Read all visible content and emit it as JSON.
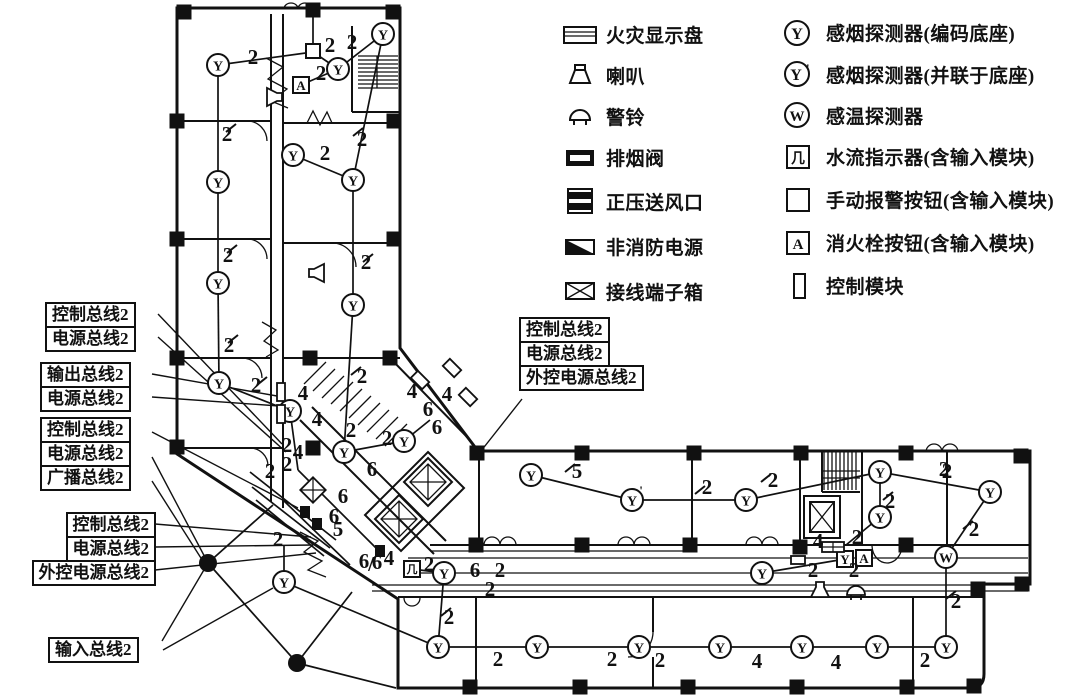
{
  "legend": {
    "left": [
      {
        "icon": "fire-display-panel",
        "label": "火灾显示盘"
      },
      {
        "icon": "speaker",
        "label": "喇叭"
      },
      {
        "icon": "alarm-bell",
        "label": "警铃"
      },
      {
        "icon": "smoke-exhaust-valve",
        "label": "排烟阀"
      },
      {
        "icon": "pressurized-air-outlet",
        "label": "正压送风口"
      },
      {
        "icon": "non-fire-power",
        "label": "非消防电源"
      },
      {
        "icon": "terminal-box",
        "label": "接线端子箱"
      }
    ],
    "right": [
      {
        "icon": "smoke-detector-coded-base",
        "label": "感烟探测器(编码底座)"
      },
      {
        "icon": "smoke-detector-parallel-base",
        "label": "感烟探测器(并联于底座)"
      },
      {
        "icon": "heat-detector",
        "label": "感温探测器"
      },
      {
        "icon": "water-flow-indicator",
        "label": "水流指示器(含输入模块)"
      },
      {
        "icon": "manual-alarm-button",
        "label": "手动报警按钮(含输入模块)"
      },
      {
        "icon": "hydrant-button",
        "label": "消火栓按钮(含输入模块)"
      },
      {
        "icon": "control-module",
        "label": "控制模块"
      }
    ],
    "glyphs": {
      "smoke": "Y",
      "smoke_parallel": "Y'",
      "heat": "W",
      "flow": "几",
      "hydrant": "A"
    }
  },
  "bus_labels": {
    "group_a": [
      "控制总线2",
      "电源总线2"
    ],
    "group_b": [
      "输出总线2",
      "电源总线2"
    ],
    "group_c": [
      "控制总线2",
      "电源总线2",
      "广播总线2"
    ],
    "group_d": [
      "控制总线2",
      "电源总线2",
      "外控电源总线2"
    ],
    "group_e": [
      "输入总线2"
    ],
    "group_mid": [
      "控制总线2",
      "电源总线2",
      "外控电源总线2"
    ]
  },
  "plan": {
    "colors": {
      "ink": "#111111",
      "paper": "#ffffff"
    },
    "wires": [
      [
        218,
        65,
        218,
        182
      ],
      [
        218,
        182,
        218,
        283
      ],
      [
        218,
        283,
        219,
        383
      ],
      [
        219,
        383,
        290,
        411
      ],
      [
        218,
        65,
        313,
        52
      ],
      [
        313,
        52,
        338,
        69
      ],
      [
        383,
        34,
        338,
        69
      ],
      [
        301,
        85,
        338,
        69
      ],
      [
        383,
        34,
        353,
        180
      ],
      [
        293,
        155,
        353,
        180
      ],
      [
        353,
        180,
        353,
        305
      ],
      [
        353,
        305,
        344,
        452
      ],
      [
        344,
        452,
        404,
        441
      ],
      [
        290,
        411,
        298,
        470
      ],
      [
        404,
        441,
        430,
        420
      ],
      [
        313,
        46,
        313,
        12
      ],
      [
        250,
        472,
        336,
        540
      ],
      [
        252,
        487,
        330,
        548
      ],
      [
        256,
        500,
        324,
        556
      ],
      [
        283,
        500,
        350,
        565
      ],
      [
        298,
        470,
        380,
        552
      ],
      [
        284,
        582,
        284,
        546
      ],
      [
        284,
        582,
        438,
        647
      ],
      [
        208,
        563,
        297,
        663
      ],
      [
        208,
        563,
        273,
        505
      ],
      [
        297,
        663,
        352,
        592
      ],
      [
        297,
        663,
        396,
        688
      ],
      [
        444,
        573,
        438,
        647
      ],
      [
        438,
        647,
        537,
        647
      ],
      [
        537,
        647,
        639,
        647
      ],
      [
        639,
        647,
        720,
        647
      ],
      [
        720,
        647,
        802,
        647
      ],
      [
        802,
        647,
        877,
        647
      ],
      [
        877,
        647,
        946,
        647
      ],
      [
        946,
        647,
        946,
        557
      ],
      [
        946,
        557,
        990,
        492
      ],
      [
        990,
        492,
        880,
        472
      ],
      [
        880,
        472,
        880,
        517
      ],
      [
        880,
        472,
        746,
        500
      ],
      [
        746,
        500,
        632,
        500
      ],
      [
        632,
        500,
        531,
        475
      ],
      [
        762,
        573,
        845,
        559
      ],
      [
        880,
        517,
        846,
        545
      ],
      [
        412,
        569,
        444,
        573
      ]
    ],
    "leaders": [
      [
        158,
        314,
        282,
        444
      ],
      [
        158,
        337,
        286,
        452
      ],
      [
        152,
        374,
        277,
        396
      ],
      [
        152,
        397,
        279,
        406
      ],
      [
        152,
        432,
        298,
        508
      ],
      [
        152,
        457,
        208,
        563
      ],
      [
        152,
        481,
        206,
        566
      ],
      [
        155,
        524,
        311,
        537
      ],
      [
        155,
        547,
        313,
        545
      ],
      [
        155,
        570,
        316,
        553
      ],
      [
        162,
        641,
        208,
        563
      ],
      [
        163,
        650,
        273,
        588
      ],
      [
        522,
        399,
        481,
        451
      ]
    ],
    "labels": [
      [
        253,
        57,
        "2"
      ],
      [
        330,
        45,
        "2"
      ],
      [
        352,
        42,
        "2"
      ],
      [
        321,
        73,
        "2"
      ],
      [
        362,
        139,
        "2"
      ],
      [
        325,
        153,
        "2"
      ],
      [
        227,
        134,
        "2"
      ],
      [
        228,
        255,
        "2"
      ],
      [
        366,
        262,
        "2"
      ],
      [
        229,
        345,
        "2"
      ],
      [
        256,
        385,
        "2"
      ],
      [
        362,
        376,
        "2"
      ],
      [
        303,
        393,
        "4"
      ],
      [
        317,
        419,
        "4"
      ],
      [
        287,
        445,
        "2"
      ],
      [
        298,
        452,
        "4"
      ],
      [
        287,
        464,
        "2"
      ],
      [
        270,
        471,
        "2"
      ],
      [
        351,
        430,
        "2"
      ],
      [
        387,
        438,
        "2"
      ],
      [
        412,
        391,
        "4"
      ],
      [
        428,
        409,
        "6"
      ],
      [
        447,
        394,
        "4"
      ],
      [
        437,
        427,
        "6"
      ],
      [
        372,
        469,
        "6"
      ],
      [
        343,
        496,
        "6"
      ],
      [
        334,
        516,
        "6"
      ],
      [
        338,
        529,
        "5"
      ],
      [
        278,
        539,
        "2"
      ],
      [
        364,
        561,
        "6"
      ],
      [
        371,
        564,
        "/"
      ],
      [
        377,
        562,
        "6"
      ],
      [
        389,
        558,
        "4"
      ],
      [
        429,
        564,
        "2"
      ],
      [
        475,
        570,
        "6"
      ],
      [
        500,
        570,
        "2"
      ],
      [
        490,
        589,
        "2"
      ],
      [
        449,
        617,
        "2"
      ],
      [
        498,
        659,
        "2"
      ],
      [
        612,
        659,
        "2"
      ],
      [
        660,
        660,
        "2"
      ],
      [
        757,
        661,
        "4"
      ],
      [
        836,
        662,
        "4"
      ],
      [
        925,
        660,
        "2"
      ],
      [
        956,
        601,
        "2"
      ],
      [
        974,
        529,
        "2"
      ],
      [
        944,
        469,
        "2"
      ],
      [
        890,
        501,
        "2"
      ],
      [
        773,
        480,
        "2"
      ],
      [
        707,
        487,
        "2"
      ],
      [
        577,
        471,
        "5"
      ],
      [
        818,
        541,
        "4"
      ],
      [
        857,
        537,
        "2"
      ],
      [
        813,
        570,
        "2"
      ],
      [
        854,
        570,
        "2"
      ],
      [
        947,
        471,
        "2"
      ]
    ],
    "devices": [
      [
        "Y",
        218,
        65
      ],
      [
        "Y",
        218,
        182
      ],
      [
        "Y",
        218,
        283
      ],
      [
        "Y",
        219,
        383
      ],
      [
        "Y",
        293,
        155
      ],
      [
        "Y",
        353,
        180
      ],
      [
        "Y",
        353,
        305
      ],
      [
        "Y",
        383,
        34
      ],
      [
        "Y",
        338,
        69
      ],
      [
        "Y",
        290,
        411
      ],
      [
        "Y",
        344,
        452
      ],
      [
        "Y",
        404,
        441
      ],
      [
        "Y",
        284,
        582
      ],
      [
        "Y",
        444,
        573
      ],
      [
        "Y",
        438,
        647
      ],
      [
        "Y",
        537,
        647
      ],
      [
        "Y",
        639,
        647
      ],
      [
        "Y",
        720,
        647
      ],
      [
        "Y",
        802,
        647
      ],
      [
        "Y",
        877,
        647
      ],
      [
        "Y",
        946,
        647
      ],
      [
        "Y",
        531,
        475
      ],
      [
        "Y",
        746,
        500
      ],
      [
        "Y",
        880,
        472
      ],
      [
        "Y",
        990,
        492
      ],
      [
        "Y",
        880,
        517
      ],
      [
        "Y",
        762,
        573
      ],
      [
        "Yp",
        632,
        500
      ],
      [
        "W",
        946,
        557
      ],
      [
        "boxA",
        301,
        85
      ],
      [
        "boxA",
        864,
        558
      ],
      [
        "boxY",
        845,
        559
      ],
      [
        "sq",
        313,
        51
      ],
      [
        "flow",
        412,
        569
      ],
      [
        "spk",
        273,
        97,
        90
      ],
      [
        "spk",
        318,
        273,
        -90
      ],
      [
        "spk",
        820,
        591,
        0
      ],
      [
        "bell",
        856,
        591
      ],
      [
        "valve",
        833,
        547
      ],
      [
        "mod",
        281,
        392
      ],
      [
        "mod",
        281,
        414
      ],
      [
        "modh",
        798,
        560
      ],
      [
        "modf",
        380,
        551
      ],
      [
        "modf",
        305,
        512
      ],
      [
        "modf",
        317,
        524
      ],
      [
        "xbox",
        313,
        490
      ],
      [
        "rot",
        420,
        380
      ],
      [
        "rot",
        452,
        368
      ],
      [
        "rot",
        468,
        397
      ],
      [
        "dot",
        208,
        563
      ],
      [
        "dot",
        297,
        663
      ]
    ],
    "columns": [
      [
        184,
        12
      ],
      [
        313,
        10
      ],
      [
        393,
        12
      ],
      [
        177,
        121
      ],
      [
        177,
        239
      ],
      [
        177,
        358
      ],
      [
        177,
        447
      ],
      [
        394,
        121
      ],
      [
        394,
        239
      ],
      [
        310,
        358
      ],
      [
        390,
        358
      ],
      [
        313,
        448
      ],
      [
        477,
        453
      ],
      [
        582,
        453
      ],
      [
        694,
        453
      ],
      [
        801,
        453
      ],
      [
        906,
        453
      ],
      [
        1021,
        456
      ],
      [
        476,
        545
      ],
      [
        582,
        545
      ],
      [
        690,
        545
      ],
      [
        800,
        547
      ],
      [
        906,
        545
      ],
      [
        1022,
        584
      ],
      [
        978,
        589
      ],
      [
        470,
        687
      ],
      [
        580,
        687
      ],
      [
        688,
        687
      ],
      [
        797,
        687
      ],
      [
        907,
        687
      ],
      [
        974,
        686
      ]
    ],
    "ticks": [
      [
        231,
        128
      ],
      [
        232,
        249
      ],
      [
        233,
        339
      ],
      [
        262,
        381
      ],
      [
        358,
        132
      ],
      [
        368,
        258
      ],
      [
        356,
        371
      ],
      [
        446,
        612
      ],
      [
        951,
        595
      ],
      [
        968,
        525
      ],
      [
        888,
        496
      ],
      [
        766,
        478
      ],
      [
        700,
        490
      ],
      [
        570,
        468
      ]
    ]
  }
}
